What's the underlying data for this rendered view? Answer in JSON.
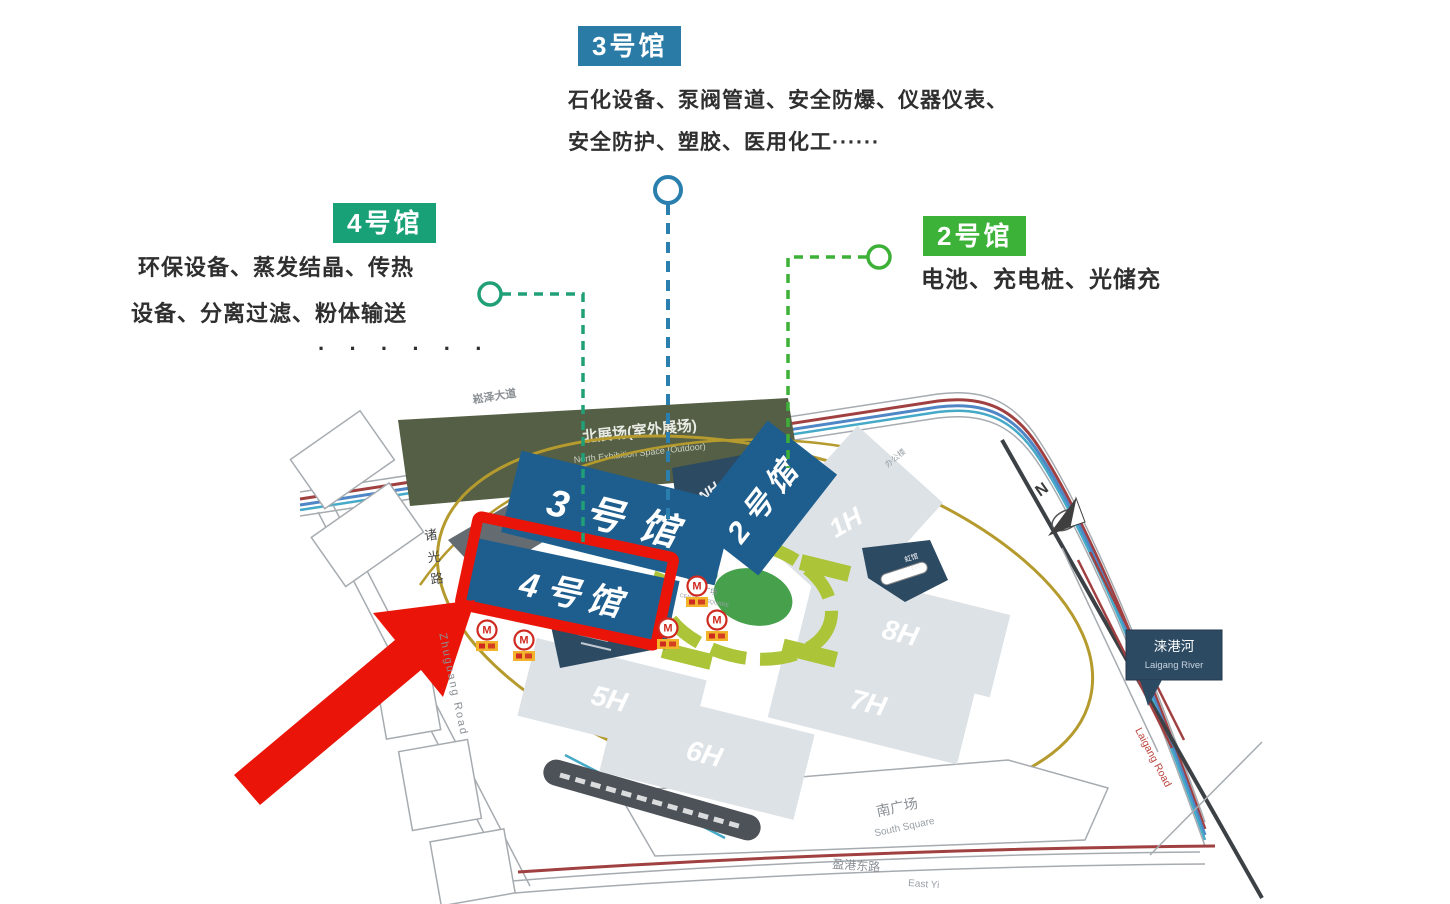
{
  "callout_hall3": {
    "title": "3号馆",
    "line1": "石化设备、泵阀管道、安全防爆、仪器仪表、",
    "line2": "安全防护、塑胶、医用化工······"
  },
  "callout_hall4": {
    "title": "4号馆",
    "line1": "环保设备、蒸发结晶、传热",
    "line2": "设备、分离过滤、粉体输送",
    "line3": "· · · · · ·"
  },
  "callout_hall2": {
    "title": "2号馆",
    "line1": "电池、充电桩、光储充"
  },
  "map": {
    "north_space_zh": "北展场(室外展场)",
    "north_space_en": "North Exhibition Space (Outdoor)",
    "halls": {
      "h1": "1H",
      "h2": "2号馆",
      "h3": "3号馆",
      "h4": "4号馆",
      "h5": "5H",
      "h6": "6H",
      "h7": "7H",
      "h8": "8H",
      "nh": "NH",
      "eh_zh": "虹馆",
      "eh_en": "EH"
    },
    "central_square_zh": "中央广场",
    "central_square_en": "CENTRAL SQUARE",
    "south_square_zh": "南广场",
    "south_square_en": "South Square",
    "river_zh": "涞港河",
    "river_en": "Laigang River",
    "roads": {
      "songze": "崧泽大道",
      "zhuguang_zh": "诸光路",
      "zhuguang_en": "Zhuguang Road",
      "laigang": "Laigang Road",
      "yinggang_zh": "盈港东路",
      "yinggang_en": "East Yi",
      "office": "办公楼"
    },
    "compass_n": "N",
    "metro_m": "M"
  },
  "colors": {
    "hall3_accent": "#2a7ca6",
    "hall4_accent": "#18a076",
    "hall2_accent": "#3db238",
    "map_hall_blue": "#1e5e8e",
    "highlight_red": "#ea1508"
  }
}
